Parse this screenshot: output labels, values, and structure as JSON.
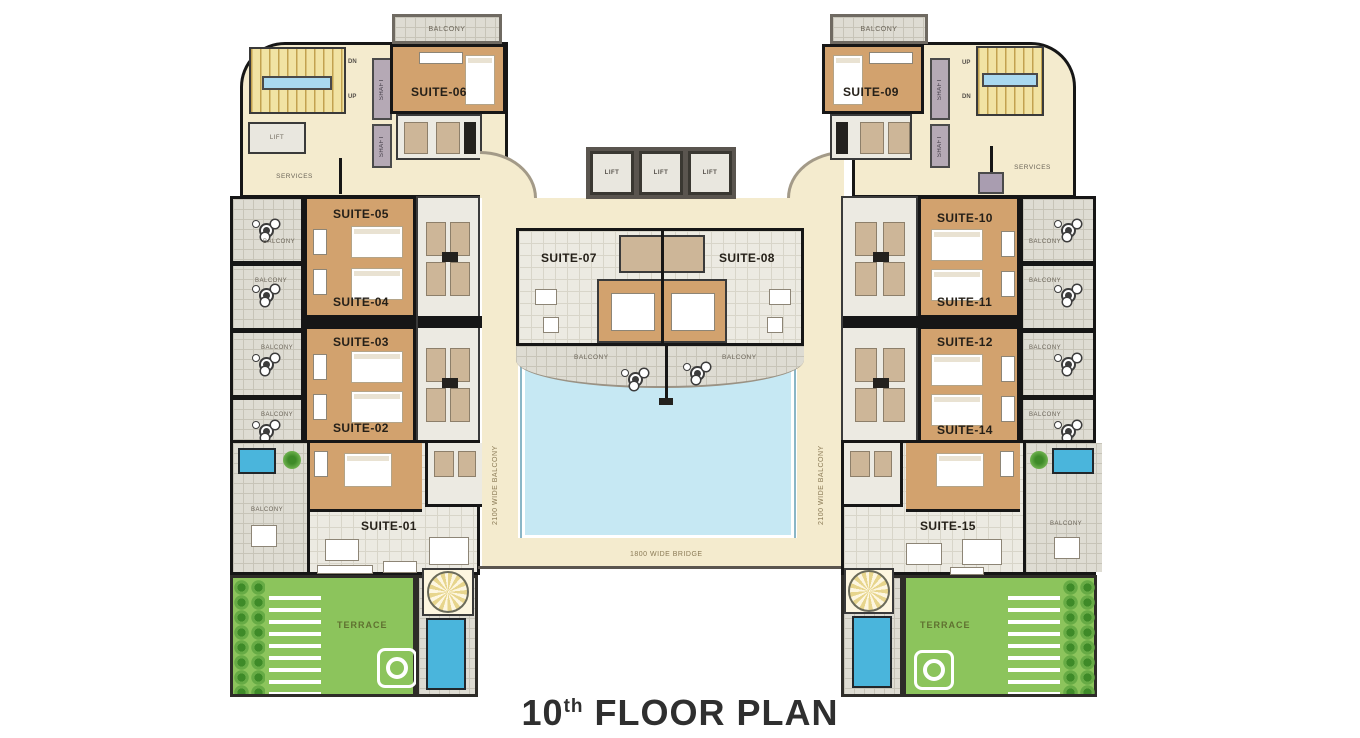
{
  "title": {
    "number": "10",
    "ordinal": "th",
    "text": " FLOOR PLAN"
  },
  "labels": {
    "balcony": "BALCONY",
    "lift": "LIFT",
    "services": "SERVICES",
    "shaft": "SHAFT",
    "dn": "DN",
    "up": "UP",
    "terrace": "TERRACE",
    "bridge": "1800 WIDE BRIDGE",
    "wide_balcony": "2100 WIDE BALCONY"
  },
  "suites": {
    "s01": "SUITE-01",
    "s02": "SUITE-02",
    "s03": "SUITE-03",
    "s04": "SUITE-04",
    "s05": "SUITE-05",
    "s06": "SUITE-06",
    "s07": "SUITE-07",
    "s08": "SUITE-08",
    "s09": "SUITE-09",
    "s10": "SUITE-10",
    "s11": "SUITE-11",
    "s12": "SUITE-12",
    "s14": "SUITE-14",
    "s15": "SUITE-15"
  },
  "colors": {
    "wall": "#161616",
    "cream": "#f4ebce",
    "suite_floor_tan": "#d2a26e",
    "balcony_tile": "#dedcd3",
    "room_gray": "#eceae2",
    "pool_large": "#c6e8f3",
    "pool_small": "#4ab5dc",
    "stairs_yellow": "#f1e3a3",
    "stairs_landing_blue": "#a9d9f0",
    "terrace_green": "#8cc45c",
    "plant_green": "#3e8a28",
    "shaft_purple": "#b5a9b5",
    "title_text": "#2f2f2f"
  }
}
